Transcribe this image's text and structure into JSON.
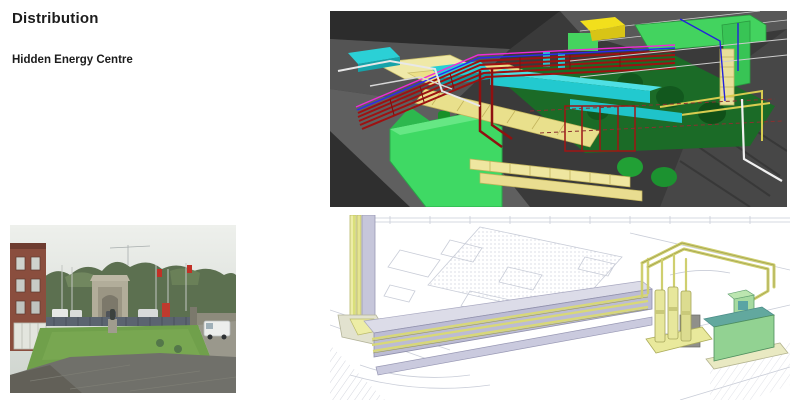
{
  "slide": {
    "title": "Distribution",
    "subtitle": "Hidden Energy Centre"
  },
  "colors": {
    "slide_background": "#ffffff",
    "title_text": "#1c1c1c",
    "bim_render": {
      "background": "#3a3a3a",
      "roof_gray": "#585858",
      "pipe_rack_red": "#9e1111",
      "duct_cyan": "#22c9cf",
      "cable_tray_yellow": "#e9e08c",
      "equipment_green_bright": "#3fd964",
      "plant_floor_green": "#1b6b27",
      "accent_blue": "#2a2af0",
      "accent_magenta": "#ef2bd8",
      "pipe_white": "#f0f0f0"
    },
    "site_photo": {
      "sky": "#e3e7e2",
      "trees": "#5c7050",
      "brick_building": "#8a4e3e",
      "lawn": "#70a04b",
      "memorial_stone": "#b2ad9a",
      "paving": "#70706a",
      "van_white": "#eceeec"
    },
    "cad_drawing": {
      "background": "#ffffff",
      "linework_gray": "#c9cdd8",
      "corridor_lavender": "#bcbcd4",
      "pipe_yellow": "#d8d878",
      "cylinder_yellow": "#e7e79c",
      "plant_green": "#92d292",
      "plant_teal": "#62a89e"
    }
  },
  "figures": {
    "bim_render": {
      "name": "3d-services-coordination-model"
    },
    "site_photo": {
      "name": "energy-centre-site-photo"
    },
    "cad_drawing": {
      "name": "distribution-route-isometric-drawing"
    }
  }
}
